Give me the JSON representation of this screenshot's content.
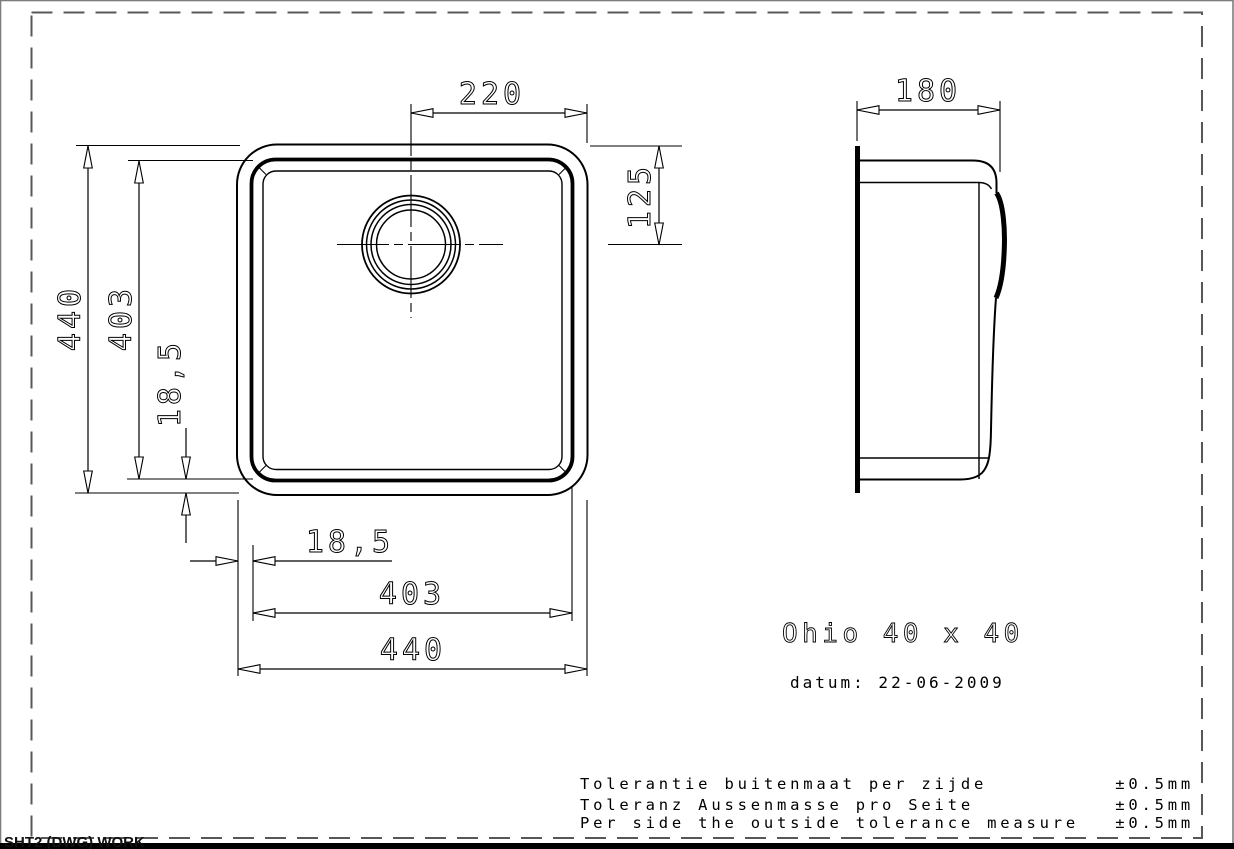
{
  "page": {
    "background": "#ffffff",
    "frame_color": "#585858",
    "line_color": "#000000",
    "sheet_tab": "SHT2 (DWG) WORK"
  },
  "drawing": {
    "title": "Ohio 40 x 40",
    "date": "datum: 22-06-2009"
  },
  "dimensions": {
    "drain_offset_width": "220",
    "drain_offset_height": "125",
    "side_depth": "180",
    "outer_size_vertical": "440",
    "bowl_size_vertical": "403",
    "rim_width_vertical": "18,5",
    "rim_width_horizontal": "18,5",
    "bowl_size_horizontal": "403",
    "outer_size_horizontal": "440"
  },
  "tolerances": [
    {
      "label": "Tolerantie buitenmaat per zijde",
      "value": "±0.5mm"
    },
    {
      "label": "Toleranz Aussenmasse pro Seite",
      "value": "±0.5mm"
    },
    {
      "label": "Per side the outside tolerance measure",
      "value": "±0.5mm"
    }
  ]
}
